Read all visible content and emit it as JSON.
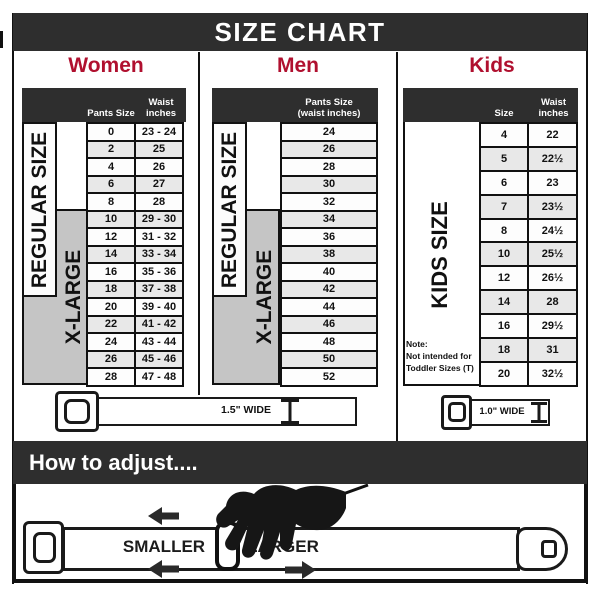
{
  "title": "SIZE CHART",
  "colors": {
    "banner_bg": "#2e2e2e",
    "heading_red": "#b0102f",
    "table_header_bg": "#2e2e2e",
    "xlarge_gray": "#c5c5c5",
    "row_alt_gray": "#e8e8e8",
    "line_black": "#111111"
  },
  "women": {
    "title": "Women",
    "col1_header": "Pants Size",
    "col2_header": "Waist inches",
    "regular_label": "REGULAR SIZE",
    "xlarge_label": "X-LARGE",
    "rows": [
      [
        "0",
        "23 - 24"
      ],
      [
        "2",
        "25"
      ],
      [
        "4",
        "26"
      ],
      [
        "6",
        "27"
      ],
      [
        "8",
        "28"
      ],
      [
        "10",
        "29 - 30"
      ],
      [
        "12",
        "31 - 32"
      ],
      [
        "14",
        "33 - 34"
      ],
      [
        "16",
        "35 - 36"
      ],
      [
        "18",
        "37 - 38"
      ],
      [
        "20",
        "39 - 40"
      ],
      [
        "22",
        "41 - 42"
      ],
      [
        "24",
        "43 - 44"
      ],
      [
        "26",
        "45 - 46"
      ],
      [
        "28",
        "47 - 48"
      ]
    ]
  },
  "men": {
    "title": "Men",
    "header_line1": "Pants Size",
    "header_line2": "(waist inches)",
    "regular_label": "REGULAR SIZE",
    "xlarge_label": "X-LARGE",
    "rows": [
      "24",
      "26",
      "28",
      "30",
      "32",
      "34",
      "36",
      "38",
      "40",
      "42",
      "44",
      "46",
      "48",
      "50",
      "52"
    ]
  },
  "kids": {
    "title": "Kids",
    "col1_header": "Size",
    "col2_header": "Waist inches",
    "side_label": "KIDS SIZE",
    "note": {
      "line1": "Note:",
      "line2": "Not intended for",
      "line3": "Toddler Sizes (T)"
    },
    "rows": [
      [
        "4",
        "22"
      ],
      [
        "5",
        "22½"
      ],
      [
        "6",
        "23"
      ],
      [
        "7",
        "23½"
      ],
      [
        "8",
        "24½"
      ],
      [
        "10",
        "25½"
      ],
      [
        "12",
        "26½"
      ],
      [
        "14",
        "28"
      ],
      [
        "16",
        "29½"
      ],
      [
        "18",
        "31"
      ],
      [
        "20",
        "32½"
      ]
    ]
  },
  "belts": {
    "adult_width_label": "1.5\" WIDE",
    "kids_width_label": "1.0\" WIDE"
  },
  "how_to": {
    "banner_title": "How to adjust....",
    "smaller_label": "SMALLER",
    "larger_label": "LARGER"
  }
}
